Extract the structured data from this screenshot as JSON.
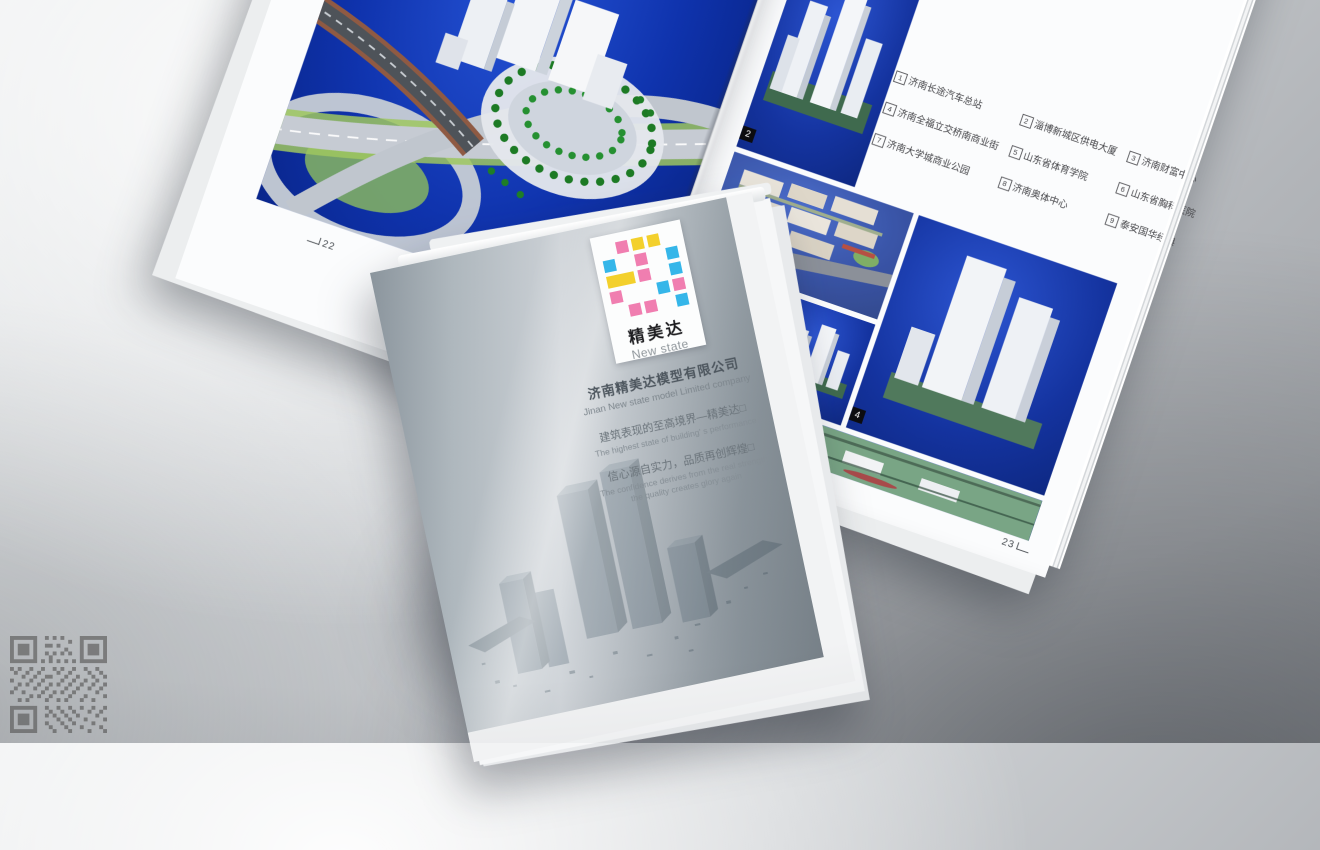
{
  "scene": {
    "description": "studio photo of printed brochures",
    "watermark_icon": "qr-code"
  },
  "spread": {
    "left_page": {
      "page_number": "22",
      "photo": "interchange-model"
    },
    "right_page": {
      "page_number": "23",
      "legend_columns": [
        {
          "items": [
            {
              "num": "1",
              "label": "济南长途汽车总站"
            },
            {
              "num": "4",
              "label": "济南全福立交桥南商业街"
            },
            {
              "num": "7",
              "label": "济南大学城商业公园"
            }
          ]
        },
        {
          "items": [
            {
              "num": "2",
              "label": "淄博新城区供电大厦"
            },
            {
              "num": "5",
              "label": "山东省体育学院"
            },
            {
              "num": "8",
              "label": "济南奥体中心"
            }
          ]
        },
        {
          "items": [
            {
              "num": "3",
              "label": "济南财富中心"
            },
            {
              "num": "6",
              "label": "山东省胸科医院"
            },
            {
              "num": "9",
              "label": "泰安国华经典"
            }
          ]
        }
      ],
      "cells": [
        {
          "badge": "2"
        },
        {
          "badge": "3"
        },
        {
          "badge": "4"
        },
        {
          "badge": "5"
        },
        {
          "badge": "6"
        },
        {
          "badge": "7"
        }
      ]
    }
  },
  "cover": {
    "logo": {
      "cn": "精美达",
      "en": "New state",
      "colors": {
        "pink": "#f07eb0",
        "yellow": "#f3d02c",
        "cyan": "#35b6e9"
      }
    },
    "company_cn": "济南精美达模型有限公司",
    "company_en": "Jinan New state model Limited company",
    "slogan1_cn": "建筑表现的至高境界—精美达□",
    "slogan1_en": "The highest state of building' s performance",
    "slogan2_cn": "信心源自实力，品质再创辉煌□",
    "slogan2_en_1": "The confidence derives from the real strength",
    "slogan2_en_2": "the quality creates glory again"
  }
}
